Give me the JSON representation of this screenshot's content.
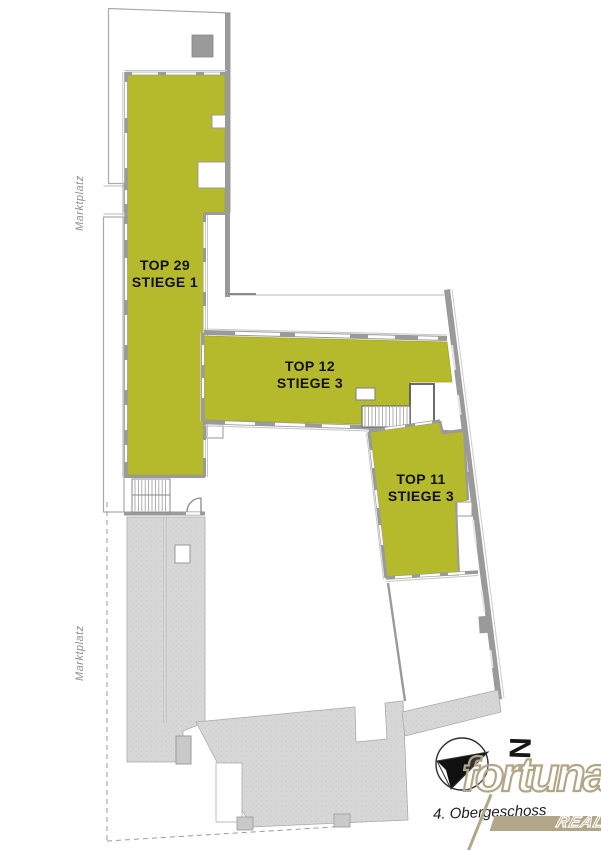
{
  "plan": {
    "floor_label": "4. Obergeschoss",
    "street_labels": [
      "Marktplatz",
      "Marktplatz"
    ],
    "units": [
      {
        "id": "top-29",
        "line1": "TOP 29",
        "line2": "STIEGE 1"
      },
      {
        "id": "top-12",
        "line1": "TOP 12",
        "line2": "STIEGE 3"
      },
      {
        "id": "top-11",
        "line1": "TOP 11",
        "line2": "STIEGE 3"
      }
    ],
    "compass": {
      "north_label": "N"
    },
    "colors": {
      "unit_fill": "#b5b92c",
      "unit_edge": "#a3a81f",
      "wall": "#9a9a9a",
      "terrace": "#d7d7d7",
      "logo_tan": "#b1a687"
    }
  },
  "logo": {
    "brand": "fortuna",
    "sub": "REAL"
  }
}
